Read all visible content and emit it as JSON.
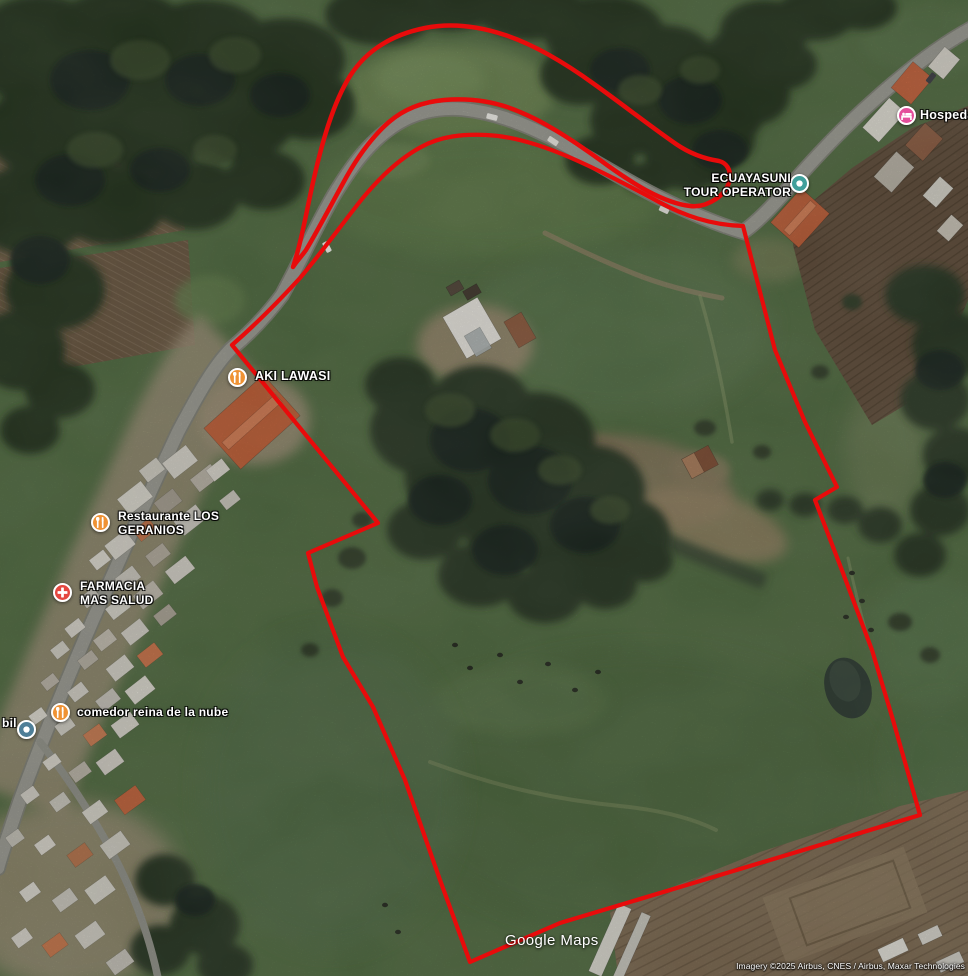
{
  "map": {
    "type": "google-maps-satellite-view",
    "watermark": "Google Maps",
    "attribution": "Imagery ©2025 Airbus, CNES / Airbus, Maxar Technologies",
    "annotations": {
      "color": "#e80b0b",
      "shapes": [
        "route-arrow-along-road",
        "property-boundary-polygon"
      ]
    },
    "pois": [
      {
        "id": "ecuayasuni-tour-operator",
        "lines": [
          "ECUAYASUNI",
          "TOUR OPERATOR"
        ],
        "marker": {
          "glyph": "generic-dot",
          "color": "#3f9f9b",
          "x": 799,
          "y": 183
        },
        "text": {
          "x": 791,
          "y": 171,
          "align": "right",
          "size": 12
        }
      },
      {
        "id": "hospedaje",
        "lines": [
          "Hospedaje"
        ],
        "marker": {
          "glyph": "lodging-bed",
          "color": "#e44f9c",
          "x": 906,
          "y": 115
        },
        "text": {
          "x": 920,
          "y": 108,
          "align": "left",
          "size": 12.5
        }
      },
      {
        "id": "aki-lawasi",
        "lines": [
          "AKI LAWASI"
        ],
        "marker": {
          "glyph": "restaurant-fork-knife",
          "color": "#ef9234",
          "x": 237,
          "y": 377
        },
        "text": {
          "x": 255,
          "y": 369,
          "align": "left",
          "size": 12.5
        }
      },
      {
        "id": "restaurante-los-geranios",
        "lines": [
          "Restaurante LOS",
          "GERANIOS"
        ],
        "marker": {
          "glyph": "restaurant-fork-knife",
          "color": "#ef9234",
          "x": 100,
          "y": 522
        },
        "text": {
          "x": 118,
          "y": 509,
          "align": "left",
          "size": 12
        }
      },
      {
        "id": "farmacia-mas-salud",
        "lines": [
          "FARMACIA",
          "MAS SALUD"
        ],
        "marker": {
          "glyph": "pharmacy-cross",
          "color": "#e4473f",
          "x": 62,
          "y": 592
        },
        "text": {
          "x": 80,
          "y": 579,
          "align": "left",
          "size": 12
        }
      },
      {
        "id": "comedor-reina-de-la-nube",
        "lines": [
          "comedor reina de la nube"
        ],
        "marker": {
          "glyph": "restaurant-fork-knife",
          "color": "#ef9234",
          "x": 60,
          "y": 712
        },
        "text": {
          "x": 77,
          "y": 705,
          "align": "left",
          "size": 12
        }
      },
      {
        "id": "bil-partial",
        "lines": [
          "bil"
        ],
        "marker": {
          "glyph": "generic-dot",
          "color": "#4e7e97",
          "x": 26,
          "y": 729
        },
        "text": {
          "x": 2,
          "y": 716,
          "align": "left",
          "size": 12
        }
      }
    ]
  }
}
